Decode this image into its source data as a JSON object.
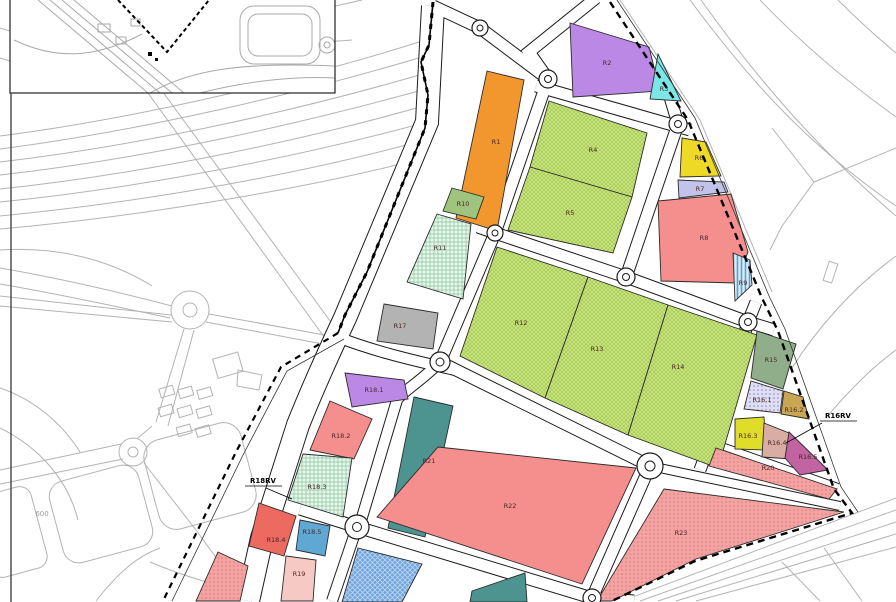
{
  "plan": {
    "parcels": [
      {
        "id": "R1",
        "label": "R1",
        "fill": "orange",
        "points": "487,71 524,80 497,231 456,218",
        "lx": 496,
        "ly": 144
      },
      {
        "id": "R2",
        "label": "R2",
        "fill": "purple",
        "points": "570,23 649,47 660,91 573,97",
        "lx": 607,
        "ly": 65
      },
      {
        "id": "R3",
        "label": "R3",
        "fill": "cyan",
        "points": "658,54 681,101 650,99",
        "lx": 664,
        "ly": 91
      },
      {
        "id": "R4",
        "label": "R4",
        "fill": "green",
        "points": "549,101 647,133 632,197 530,167",
        "lx": 593,
        "ly": 152
      },
      {
        "id": "R5",
        "label": "R5",
        "fill": "green",
        "points": "530,167 632,197 613,253 508,230",
        "lx": 570,
        "ly": 215
      },
      {
        "id": "R6",
        "label": "R6",
        "fill": "yellow",
        "points": "682,138 706,142 721,176 680,177",
        "lx": 699,
        "ly": 160
      },
      {
        "id": "R7",
        "label": "R7",
        "fill": "lavender",
        "points": "678,180 724,182 728,192 679,198",
        "lx": 700,
        "ly": 191
      },
      {
        "id": "R8",
        "label": "R8",
        "fill": "salmon",
        "points": "658,201 731,194 748,252 736,283 661,281",
        "lx": 704,
        "ly": 240
      },
      {
        "id": "R9",
        "label": "R9",
        "fill": "bluestripe",
        "points": "733,253 750,260 752,285 735,301",
        "lx": 743,
        "ly": 285
      },
      {
        "id": "R10",
        "label": "R10",
        "fill": "sage",
        "points": "452,188 484,197 476,219 443,211",
        "lx": 463,
        "ly": 206
      },
      {
        "id": "R11",
        "label": "R11",
        "fill": "mint",
        "points": "437,214 471,224 463,299 407,282",
        "lx": 440,
        "ly": 250
      },
      {
        "id": "R12",
        "label": "R12",
        "fill": "green",
        "points": "497,247 588,277 545,398 460,356",
        "lx": 521,
        "ly": 325
      },
      {
        "id": "R13",
        "label": "R13",
        "fill": "green",
        "points": "588,277 668,305 628,435 545,398",
        "lx": 597,
        "ly": 351
      },
      {
        "id": "R14",
        "label": "R14",
        "fill": "green",
        "points": "668,305 757,335 718,468 628,435",
        "lx": 678,
        "ly": 369
      },
      {
        "id": "R15",
        "label": "R15",
        "fill": "sage2",
        "points": "757,331 796,344 783,389 751,378",
        "lx": 771,
        "ly": 362
      },
      {
        "id": "R16.1",
        "label": "R16.1",
        "fill": "lavdots",
        "points": "751,381 783,391 780,413 744,409",
        "lx": 762,
        "ly": 402
      },
      {
        "id": "R16.2",
        "label": "R16.2",
        "fill": "khaki",
        "points": "784,391 803,397 809,419 781,414",
        "lx": 794,
        "ly": 412
      },
      {
        "id": "R16.3",
        "label": "R16.3",
        "fill": "yellow2",
        "points": "735,419 764,417 766,450 735,449",
        "lx": 748,
        "ly": 438
      },
      {
        "id": "R16.4",
        "label": "R16.4",
        "fill": "dusty",
        "points": "764,423 789,433 791,459 762,457",
        "lx": 777,
        "ly": 445
      },
      {
        "id": "R16.5",
        "label": "R16.5",
        "fill": "magenta",
        "points": "789,432 828,470 800,475 785,458",
        "lx": 808,
        "ly": 459
      },
      {
        "id": "R17",
        "label": "R17",
        "fill": "gray",
        "points": "384,304 438,313 433,349 377,341",
        "lx": 400,
        "ly": 328
      },
      {
        "id": "R18.1",
        "label": "R18.1",
        "fill": "purple",
        "points": "345,373 404,380 408,399 352,407",
        "lx": 374,
        "ly": 392
      },
      {
        "id": "R18.2",
        "label": "R18.2",
        "fill": "salmon",
        "points": "330,401 372,419 354,459 310,450",
        "lx": 341,
        "ly": 438
      },
      {
        "id": "R18.3",
        "label": "R18.3",
        "fill": "mint",
        "points": "303,454 352,458 343,517 288,500",
        "lx": 317,
        "ly": 489
      },
      {
        "id": "R18.4",
        "label": "R18.4",
        "fill": "red",
        "points": "259,503 296,516 284,556 249,546",
        "lx": 276,
        "ly": 542
      },
      {
        "id": "R18.5",
        "label": "R18.5",
        "fill": "blue",
        "points": "300,520 330,526 325,556 296,550",
        "lx": 312,
        "ly": 534
      },
      {
        "id": "R19",
        "label": "R19",
        "fill": "lightpink",
        "points": "286,556 316,560 313,601 281,601",
        "lx": 299,
        "ly": 576
      },
      {
        "id": "R20",
        "label": "R20",
        "fill": "pinkdots",
        "points": "716,448 837,489 829,499 709,466",
        "lx": 768,
        "ly": 470
      },
      {
        "id": "R21",
        "label": "R21",
        "fill": "teal",
        "points": "414,397 453,406 425,537 388,528",
        "lx": 429,
        "ly": 463
      },
      {
        "id": "R22",
        "label": "R22",
        "fill": "salmon",
        "points": "438,447 636,468 582,584 377,517",
        "lx": 510,
        "ly": 508
      },
      {
        "id": "R23",
        "label": "R23",
        "fill": "pinkdots",
        "points": "664,489 844,512 696,559 612,601 597,601",
        "lx": 681,
        "ly": 535
      },
      {
        "id": "RX1",
        "label": "",
        "fill": "bluecross",
        "points": "358,548 422,564 402,602 342,602",
        "lx": 0,
        "ly": 0
      },
      {
        "id": "RX2",
        "label": "",
        "fill": "teal",
        "points": "472,591 525,573 527,602 470,602",
        "lx": 0,
        "ly": 0
      },
      {
        "id": "RX3",
        "label": "",
        "fill": "pinkdots",
        "points": "218,552 248,566 240,601 196,601",
        "lx": 0,
        "ly": 0
      }
    ],
    "annotations": [
      {
        "id": "r16rv-label",
        "text": "R16RV",
        "x": 838,
        "y": 418
      },
      {
        "id": "r18rv-label",
        "text": "R18RV",
        "x": 263,
        "y": 483
      },
      {
        "id": "elevation-600",
        "text": "600",
        "x": 42,
        "y": 516
      }
    ],
    "palette": {
      "orange": "#F2962E",
      "purple": "#BC88E6",
      "cyan": "#7CE5E6",
      "green_base": "#A6CE45",
      "yellow": "#EED927",
      "yellow2": "#DFDC2A",
      "lavender": "#C3C2EA",
      "salmon": "#F48F8E",
      "bluestripe_base": "#D9EDF9",
      "sage": "#9EC47E",
      "sage2": "#90AE8A",
      "mint_base": "#E9F5EC",
      "gray": "#B3B3B3",
      "red": "#EC6A60",
      "blue": "#5FA8D3",
      "lightpink": "#F7C9C4",
      "teal": "#4D9390",
      "khaki": "#C8A653",
      "dusty": "#D9ACA4",
      "magenta": "#C263A2",
      "pinkdots_base": "#F4A3A3",
      "bluecross_base": "#6FA4DE",
      "boundary": "#000000",
      "road_casing": "#1b1b1b",
      "context_lines": "#b3b3b3",
      "label_color": "#4a2626"
    }
  }
}
